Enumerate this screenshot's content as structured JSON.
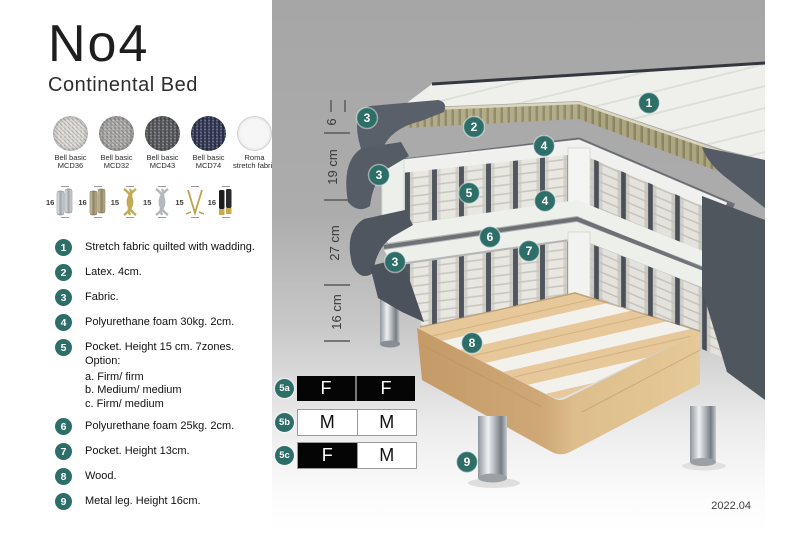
{
  "brand": {
    "title": "No4",
    "subtitle": "Continental Bed"
  },
  "fabrics": [
    {
      "line1": "Bell basic",
      "line2": "MCD36",
      "color": "#d8d7d3"
    },
    {
      "line1": "Bell basic",
      "line2": "MCD32",
      "color": "#a6a5a3"
    },
    {
      "line1": "Bell basic",
      "line2": "MCD43",
      "color": "#56575b"
    },
    {
      "line1": "Bell basic",
      "line2": "MCD74",
      "color": "#303553"
    },
    {
      "line1": "Roma",
      "line2": "stretch fabric",
      "color": "#f6f6f6"
    }
  ],
  "legs": [
    {
      "height": "16",
      "type": "cylinder-silver"
    },
    {
      "height": "16",
      "type": "cylinder-bronze"
    },
    {
      "height": "15",
      "type": "twist-gold"
    },
    {
      "height": "15",
      "type": "twist-silver"
    },
    {
      "height": "15",
      "type": "hairpin-gold"
    },
    {
      "height": "16",
      "type": "cylinder-black-gold"
    }
  ],
  "features": [
    {
      "num": "1",
      "text": "Stretch fabric quilted with wadding."
    },
    {
      "num": "2",
      "text": "Latex. 4cm."
    },
    {
      "num": "3",
      "text": "Fabric."
    },
    {
      "num": "4",
      "text": "Polyurethane foam 30kg. 2cm."
    },
    {
      "num": "5",
      "text": "Pocket. Height 15 cm. 7zones. Option:",
      "options": [
        "a. Firm/ firm",
        "b. Medium/ medium",
        "c. Firm/ medium"
      ]
    },
    {
      "num": "6",
      "text": "Polyurethane foam 25kg. 2cm."
    },
    {
      "num": "7",
      "text": "Pocket. Height 13cm."
    },
    {
      "num": "8",
      "text": "Wood."
    },
    {
      "num": "9",
      "text": "Metal leg. Height 16cm."
    }
  ],
  "diagram": {
    "measurements": [
      {
        "label": "6"
      },
      {
        "label": "19 cm"
      },
      {
        "label": "27 cm"
      },
      {
        "label": "16 cm"
      }
    ],
    "callouts": {
      "c1": "1",
      "c2": "2",
      "c3a": "3",
      "c3b": "3",
      "c3c": "3",
      "c4a": "4",
      "c4b": "4",
      "c5": "5",
      "c6": "6",
      "c7": "7",
      "c8": "8",
      "c9": "9"
    },
    "firmness": [
      {
        "id": "5a",
        "left": "F",
        "right": "F"
      },
      {
        "id": "5b",
        "left": "M",
        "right": "M"
      },
      {
        "id": "5c",
        "left": "F",
        "right": "M"
      }
    ]
  },
  "footer": {
    "version": "2022.04"
  },
  "colors": {
    "accent": "#2e6e69",
    "panel_top": "#a6a6a6",
    "panel_bottom": "#ffffff",
    "upholstery": "#565c66",
    "latex": "#b2ac8b",
    "wood": "#e2c297",
    "chrome": "#c7cbce"
  }
}
